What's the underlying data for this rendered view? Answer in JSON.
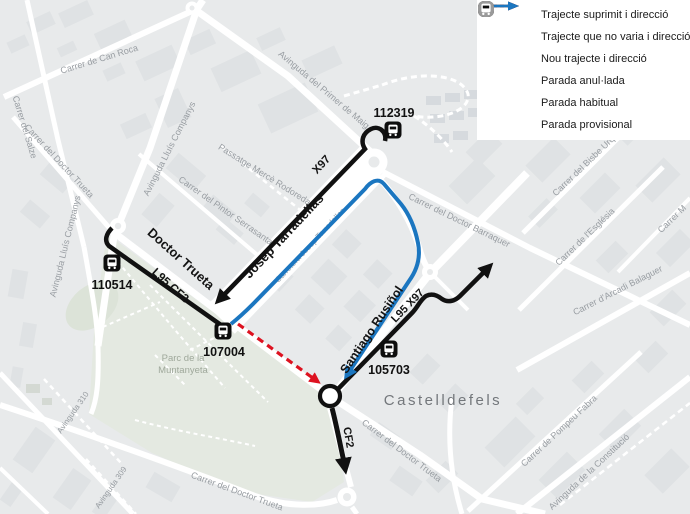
{
  "colors": {
    "suppressed": "#dd1220",
    "unchanged": "#111111",
    "new": "#1b76c0",
    "stop_regular": "#0d0d0d",
    "stop_provisional": "#9a9a9a",
    "map_background": "#e8eaeb",
    "park": "#e4e9e1"
  },
  "legend": {
    "items": [
      {
        "id": "suppressed",
        "label": "Trajecte suprimit i direcció",
        "icon": "dashed-red-arrow"
      },
      {
        "id": "unchanged",
        "label": "Trajecte que no varia i direcció",
        "icon": "black-arrow"
      },
      {
        "id": "new",
        "label": "Nou trajecte i direcció",
        "icon": "blue-arrow"
      },
      {
        "id": "cancelled-stop",
        "label": "Parada anul·lada",
        "icon": "cancelled-stop"
      },
      {
        "id": "regular-stop",
        "label": "Parada habitual",
        "icon": "black-bus-stop"
      },
      {
        "id": "provisional-stop",
        "label": "Parada provisional",
        "icon": "gray-bus-stop"
      }
    ]
  },
  "stops": [
    {
      "code": "112319",
      "type": "habitual"
    },
    {
      "code": "110514",
      "type": "habitual"
    },
    {
      "code": "107004",
      "type": "habitual"
    },
    {
      "code": "105703",
      "type": "habitual"
    }
  ],
  "route_labels": [
    {
      "text": "X97"
    },
    {
      "text": "Josep Tarradellas"
    },
    {
      "text": "Doctor Trueta"
    },
    {
      "text": "L95 CF2"
    },
    {
      "text": "Santiago Rusiñol"
    },
    {
      "text": "L95 X97"
    },
    {
      "text": "CF2"
    }
  ],
  "street_labels": [
    {
      "text": "Carrer del Salze"
    },
    {
      "text": "Carrer de Can Roca"
    },
    {
      "text": "Carrer del Doctor Trueta"
    },
    {
      "text": "Avinguda Lluís Companys"
    },
    {
      "text": "Avinguda Lluís Companys"
    },
    {
      "text": "Avinguda del Primer de Maig"
    },
    {
      "text": "Passatge Mercè Rodoreda"
    },
    {
      "text": "Carrer del Pintor Serrasanta"
    },
    {
      "text": "Carretera Josep Tarradellas"
    },
    {
      "text": "Carrer del Doctor Barraquer"
    },
    {
      "text": "Carrer del Bisbe Urquinaona"
    },
    {
      "text": "Carrer de l'Església"
    },
    {
      "text": "Carrer M"
    },
    {
      "text": "Carrer d'Arcadi Balaguer"
    },
    {
      "text": "Carrer de Pompeu Fabra"
    },
    {
      "text": "Avinguda de la Constitució"
    },
    {
      "text": "Carrer del Doctor Trueta"
    },
    {
      "text": "Carrer del Doctor Trueta"
    },
    {
      "text": "Avinguda 310"
    },
    {
      "text": "Avinguda 309"
    }
  ],
  "place_labels": {
    "city": "Castelldefels",
    "park_line1": "Parc de la",
    "park_line2": "Muntanyeta"
  }
}
